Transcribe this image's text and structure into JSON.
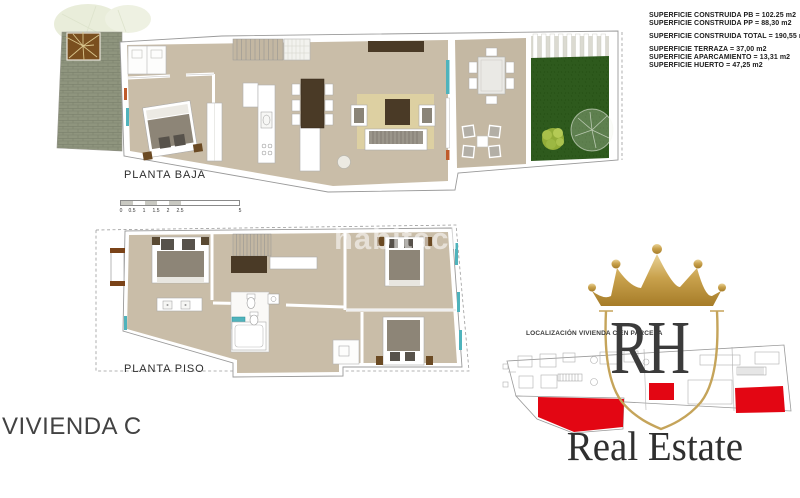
{
  "title_block": {
    "construida_pb": "SUPERFICIE CONSTRUIDA PB = 102.25 m2",
    "construida_pp": "SUPERFICIE CONSTRUIDA PP = 88,30 m2",
    "construida_total": "SUPERFICIE CONSTRUIDA TOTAL  = 190,55 m2",
    "terraza": "SUPERFICIE TERRAZA  = 37,00 m2",
    "aparcamiento": "SUPERFICIE APARCAMIENTO  = 13,31 m2",
    "huerto": "SUPERFICIE HUERTO  = 47,25 m2"
  },
  "plans": {
    "ground_floor_label": "PLANTA BAJA",
    "upper_floor_label": "PLANTA PISO"
  },
  "scale_bar": {
    "ticks": [
      "0",
      "0.5",
      "1",
      "1.5",
      "2",
      "2.5",
      "5"
    ]
  },
  "unit": {
    "label": "VIVIENDA C"
  },
  "watermark": {
    "text": "habitaclia"
  },
  "logo": {
    "initials": "RH",
    "name": "Real Estate",
    "location_caption": "LOCALIZACIÓN VIVIENDA C EN PARCELA"
  },
  "colors": {
    "accent_red": "#e30613",
    "gold": "#c9a24d",
    "floor_beige": "#c9bda8",
    "lawn_green": "#2e5a1d",
    "teal_window": "#4fb3bc",
    "dark_wood": "#4a3a26"
  }
}
